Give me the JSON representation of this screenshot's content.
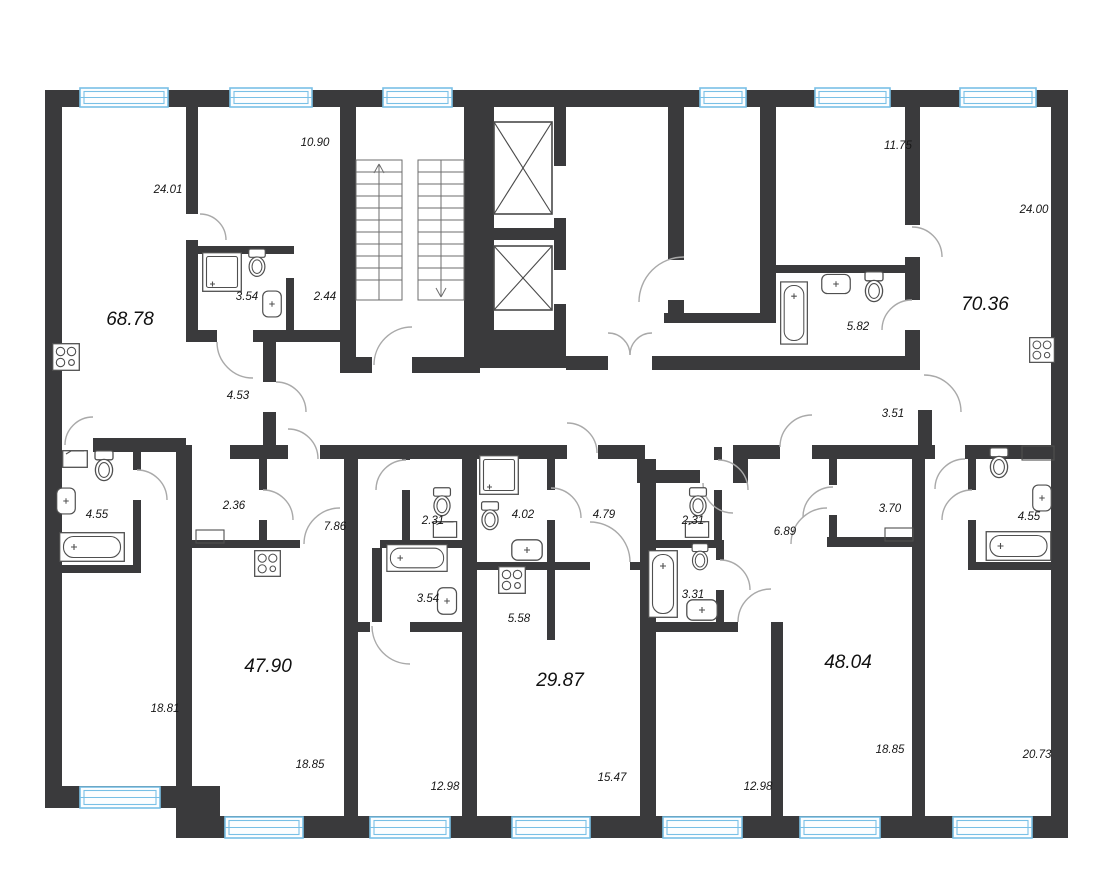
{
  "document_type": "apartment-floor-plan",
  "colors": {
    "wall": "#3a3a3c",
    "window": "#79c0e6",
    "fixture": "#4f4f4f",
    "label": "#161616"
  },
  "apartments": [
    {
      "total": "68.78",
      "rooms": [
        {
          "name": "living-room",
          "area": "24.01"
        },
        {
          "name": "bedroom",
          "area": "10.90"
        },
        {
          "name": "bathroom",
          "area": "3.54"
        },
        {
          "name": "hall",
          "area": "2.44"
        },
        {
          "name": "corridor",
          "area": "4.53"
        },
        {
          "name": "bedroom-2",
          "area": "18.81"
        },
        {
          "name": "bathroom-2",
          "area": "4.55"
        }
      ]
    },
    {
      "total": "70.36",
      "rooms": [
        {
          "name": "bedroom",
          "area": "11.75"
        },
        {
          "name": "living-room",
          "area": "24.00"
        },
        {
          "name": "bathroom",
          "area": "5.82"
        },
        {
          "name": "hall",
          "area": "3.51"
        },
        {
          "name": "bedroom-2",
          "area": "20.73"
        },
        {
          "name": "bathroom-2",
          "area": "4.55"
        }
      ]
    },
    {
      "total": "47.90",
      "rooms": [
        {
          "name": "kitchen-living-room",
          "area": "18.85"
        },
        {
          "name": "bedroom",
          "area": "12.98"
        },
        {
          "name": "hall",
          "area": "7.86"
        },
        {
          "name": "wardrobe",
          "area": "2.36"
        },
        {
          "name": "wc",
          "area": "2.31"
        },
        {
          "name": "bathroom",
          "area": "3.54"
        }
      ]
    },
    {
      "total": "29.87",
      "rooms": [
        {
          "name": "living-room",
          "area": "15.47"
        },
        {
          "name": "kitchen",
          "area": "5.58"
        },
        {
          "name": "hall",
          "area": "4.79"
        },
        {
          "name": "bathroom",
          "area": "4.02"
        }
      ]
    },
    {
      "total": "48.04",
      "rooms": [
        {
          "name": "kitchen-living-room",
          "area": "18.85"
        },
        {
          "name": "bedroom",
          "area": "12.98"
        },
        {
          "name": "hall",
          "area": "6.89"
        },
        {
          "name": "wardrobe",
          "area": "3.70"
        },
        {
          "name": "wc",
          "area": "2.31"
        },
        {
          "name": "bathroom",
          "area": "3.31"
        }
      ]
    }
  ]
}
